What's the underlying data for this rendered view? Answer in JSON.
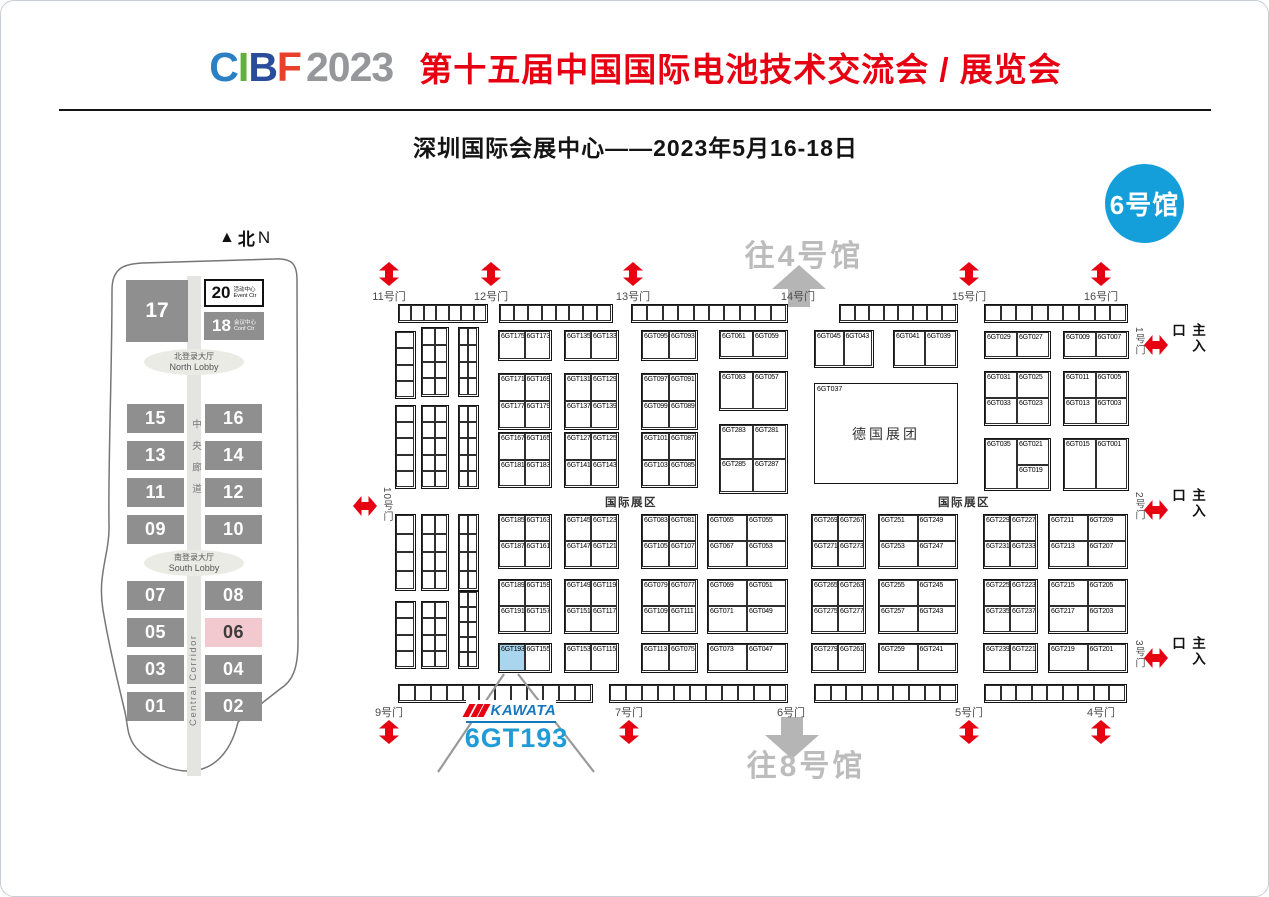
{
  "header": {
    "logo_letters": [
      {
        "ch": "C",
        "color": "#2b7fc3"
      },
      {
        "ch": "I",
        "color": "#62ae3e"
      },
      {
        "ch": "B",
        "color": "#2a4d9b"
      },
      {
        "ch": "F",
        "color": "#e8402a"
      },
      {
        "ch": "2023",
        "color": "#96979b"
      }
    ],
    "title": "第十五届中国国际电池技术交流会 / 展览会",
    "title_color": "#e60012",
    "subtitle": "深圳国际会展中心——2023年5月16-18日",
    "hall_badge": "6号馆",
    "hall_badge_color": "#149fdb"
  },
  "minimap": {
    "north_label_cn": "北",
    "north_label_en": "N",
    "hall17": "17",
    "event_center": {
      "num": "20",
      "cn": "活动中心",
      "en": "Event Ctr"
    },
    "conf_center": {
      "num": "18",
      "cn": "会议中心",
      "en": "Conf Ctr"
    },
    "north_lobby": {
      "cn": "北登录大厅",
      "en": "North Lobby"
    },
    "south_lobby": {
      "cn": "南登录大厅",
      "en": "South Lobby"
    },
    "corridor_cn": "中央廊道",
    "corridor_en": "Central Corridor",
    "halls_mid": [
      [
        "15",
        "16"
      ],
      [
        "13",
        "14"
      ],
      [
        "11",
        "12"
      ],
      [
        "09",
        "10"
      ]
    ],
    "halls_south": [
      [
        "07",
        "08"
      ],
      [
        "05",
        "06"
      ],
      [
        "03",
        "04"
      ],
      [
        "01",
        "02"
      ]
    ],
    "highlighted_hall": "06",
    "hall_color": "#8f8f8f",
    "highlight_color": "#f2c9ce"
  },
  "map": {
    "zone_label": "国际展区",
    "zone_label_positions": [
      {
        "x": 604,
        "y": 493
      },
      {
        "x": 937,
        "y": 493
      }
    ],
    "to_hall_4": "往4号馆",
    "to_hall_8": "往8号馆",
    "main_entrance_label": "主入口",
    "arrow_red": "#e60012",
    "arrow_gray": "#b5b5b5",
    "doors_top": [
      {
        "label": "11号门",
        "x": 388
      },
      {
        "label": "12号门",
        "x": 490
      },
      {
        "label": "13号门",
        "x": 632
      },
      {
        "label": "14号门",
        "x": 797,
        "gray": true
      },
      {
        "label": "15号门",
        "x": 968
      },
      {
        "label": "16号门",
        "x": 1100
      }
    ],
    "doors_bottom": [
      {
        "label": "9号门",
        "x": 388
      },
      {
        "label": "7号门",
        "x": 628
      },
      {
        "label": "6号门",
        "x": 790,
        "gray": true
      },
      {
        "label": "5号门",
        "x": 968
      },
      {
        "label": "4号门",
        "x": 1100
      }
    ],
    "door_left": {
      "label": "10号门",
      "x": 368,
      "y": 500
    },
    "entrances_right": [
      {
        "door": "1号门",
        "y": 344
      },
      {
        "door": "2号门",
        "y": 509
      },
      {
        "door": "3号门",
        "y": 657
      }
    ],
    "big_booth": {
      "id": "6GT037",
      "name": "德国展团",
      "x": 813,
      "y": 382,
      "w": 144,
      "h": 101
    },
    "highlight_booth": "6GT193",
    "highlight_color": "#a9d6ee",
    "callout": {
      "logo": "KAWATA",
      "booth": "6GT193"
    },
    "blocks": [
      {
        "x": 497,
        "y": 329,
        "w": 54,
        "h": 31,
        "rows": [
          [
            "6GT175",
            "6GT173"
          ]
        ]
      },
      {
        "x": 563,
        "y": 329,
        "w": 55,
        "h": 31,
        "rows": [
          [
            "6GT135",
            "6GT133"
          ]
        ]
      },
      {
        "x": 640,
        "y": 329,
        "w": 57,
        "h": 31,
        "rows": [
          [
            "6GT095",
            "6GT093"
          ]
        ]
      },
      {
        "x": 718,
        "y": 329,
        "w": 69,
        "h": 29,
        "rows": [
          [
            "6GT061",
            "6GT059"
          ]
        ]
      },
      {
        "x": 813,
        "y": 329,
        "w": 60,
        "h": 38,
        "rows": [
          [
            "6GT045",
            "6GT043"
          ]
        ]
      },
      {
        "x": 892,
        "y": 329,
        "w": 65,
        "h": 38,
        "rows": [
          [
            "6GT041",
            "6GT039"
          ]
        ]
      },
      {
        "x": 983,
        "y": 330,
        "w": 67,
        "h": 28,
        "rows": [
          [
            "6GT029",
            "6GT027"
          ]
        ]
      },
      {
        "x": 1062,
        "y": 330,
        "w": 66,
        "h": 28,
        "rows": [
          [
            "6GT009",
            "6GT007"
          ]
        ]
      },
      {
        "x": 497,
        "y": 372,
        "w": 54,
        "h": 57,
        "rows": [
          [
            "6GT171",
            "6GT169"
          ],
          [
            "6GT177",
            "6GT179"
          ]
        ]
      },
      {
        "x": 563,
        "y": 372,
        "w": 55,
        "h": 57,
        "rows": [
          [
            "6GT131",
            "6GT129"
          ],
          [
            "6GT137",
            "6GT139"
          ]
        ]
      },
      {
        "x": 640,
        "y": 372,
        "w": 57,
        "h": 57,
        "rows": [
          [
            "6GT097",
            "6GT091"
          ],
          [
            "6GT099",
            "6GT089"
          ]
        ]
      },
      {
        "x": 718,
        "y": 370,
        "w": 69,
        "h": 40,
        "rows": [
          [
            "6GT063",
            "6GT057"
          ]
        ]
      },
      {
        "x": 983,
        "y": 370,
        "w": 67,
        "h": 55,
        "rows": [
          [
            "6GT031",
            "6GT025"
          ],
          [
            "6GT033",
            "6GT023"
          ]
        ]
      },
      {
        "x": 1062,
        "y": 370,
        "w": 66,
        "h": 55,
        "rows": [
          [
            "6GT011",
            "6GT005"
          ],
          [
            "6GT013",
            "6GT003"
          ]
        ]
      },
      {
        "x": 497,
        "y": 431,
        "w": 54,
        "h": 56,
        "rows": [
          [
            "6GT167",
            "6GT165"
          ],
          [
            "6GT181",
            "6GT183"
          ]
        ]
      },
      {
        "x": 563,
        "y": 431,
        "w": 55,
        "h": 56,
        "rows": [
          [
            "6GT127",
            "6GT125"
          ],
          [
            "6GT141",
            "6GT143"
          ]
        ]
      },
      {
        "x": 640,
        "y": 431,
        "w": 57,
        "h": 56,
        "rows": [
          [
            "6GT101",
            "6GT087"
          ],
          [
            "6GT103",
            "6GT085"
          ]
        ]
      },
      {
        "x": 718,
        "y": 423,
        "w": 69,
        "h": 70,
        "rows": [
          [
            "6GT283",
            "6GT281"
          ],
          [
            "6GT285",
            "6GT287"
          ]
        ]
      },
      {
        "x": 983,
        "y": 437,
        "w": 67,
        "h": 53,
        "cells": [
          {
            "id": "6GT035",
            "fx": 0,
            "fy": 0,
            "fw": 0.5,
            "fh": 1
          },
          {
            "id": "6GT021",
            "fx": 0.5,
            "fy": 0,
            "fw": 0.5,
            "fh": 0.52
          },
          {
            "id": "6GT019",
            "fx": 0.5,
            "fy": 0.52,
            "fw": 0.5,
            "fh": 0.48
          }
        ]
      },
      {
        "x": 1062,
        "y": 437,
        "w": 66,
        "h": 53,
        "rows": [
          [
            "6GT015",
            "6GT001"
          ]
        ]
      },
      {
        "x": 497,
        "y": 513,
        "w": 54,
        "h": 55,
        "rows": [
          [
            "6GT185",
            "6GT163"
          ],
          [
            "6GT187",
            "6GT161"
          ]
        ]
      },
      {
        "x": 563,
        "y": 513,
        "w": 55,
        "h": 55,
        "rows": [
          [
            "6GT145",
            "6GT123"
          ],
          [
            "6GT147",
            "6GT121"
          ]
        ]
      },
      {
        "x": 640,
        "y": 513,
        "w": 57,
        "h": 55,
        "rows": [
          [
            "6GT083",
            "6GT081"
          ],
          [
            "6GT105",
            "6GT107"
          ]
        ]
      },
      {
        "x": 706,
        "y": 513,
        "w": 81,
        "h": 55,
        "rows": [
          [
            "6GT065",
            "6GT055"
          ],
          [
            "6GT067",
            "6GT053"
          ]
        ]
      },
      {
        "x": 810,
        "y": 513,
        "w": 55,
        "h": 55,
        "rows": [
          [
            "6GT269",
            "6GT267"
          ],
          [
            "6GT271",
            "6GT273"
          ]
        ]
      },
      {
        "x": 877,
        "y": 513,
        "w": 80,
        "h": 55,
        "rows": [
          [
            "6GT251",
            "6GT249"
          ],
          [
            "6GT253",
            "6GT247"
          ]
        ]
      },
      {
        "x": 982,
        "y": 513,
        "w": 55,
        "h": 55,
        "rows": [
          [
            "6GT229",
            "6GT227"
          ],
          [
            "6GT231",
            "6GT233"
          ]
        ]
      },
      {
        "x": 1047,
        "y": 513,
        "w": 80,
        "h": 55,
        "rows": [
          [
            "6GT211",
            "6GT209"
          ],
          [
            "6GT213",
            "6GT207"
          ]
        ]
      },
      {
        "x": 497,
        "y": 578,
        "w": 54,
        "h": 55,
        "rows": [
          [
            "6GT189",
            "6GT159"
          ],
          [
            "6GT191",
            "6GT157"
          ]
        ]
      },
      {
        "x": 563,
        "y": 578,
        "w": 55,
        "h": 55,
        "rows": [
          [
            "6GT149",
            "6GT119"
          ],
          [
            "6GT151",
            "6GT117"
          ]
        ]
      },
      {
        "x": 640,
        "y": 578,
        "w": 57,
        "h": 55,
        "rows": [
          [
            "6GT079",
            "6GT077"
          ],
          [
            "6GT109",
            "6GT111"
          ]
        ]
      },
      {
        "x": 706,
        "y": 578,
        "w": 81,
        "h": 55,
        "rows": [
          [
            "6GT069",
            "6GT051"
          ],
          [
            "6GT071",
            "6GT049"
          ]
        ]
      },
      {
        "x": 810,
        "y": 578,
        "w": 55,
        "h": 55,
        "rows": [
          [
            "6GT265",
            "6GT263"
          ],
          [
            "6GT275",
            "6GT277"
          ]
        ]
      },
      {
        "x": 877,
        "y": 578,
        "w": 80,
        "h": 55,
        "rows": [
          [
            "6GT255",
            "6GT245"
          ],
          [
            "6GT257",
            "6GT243"
          ]
        ]
      },
      {
        "x": 982,
        "y": 578,
        "w": 55,
        "h": 55,
        "rows": [
          [
            "6GT225",
            "6GT223"
          ],
          [
            "6GT235",
            "6GT237"
          ]
        ]
      },
      {
        "x": 1047,
        "y": 578,
        "w": 80,
        "h": 55,
        "rows": [
          [
            "6GT215",
            "6GT205"
          ],
          [
            "6GT217",
            "6GT203"
          ]
        ]
      },
      {
        "x": 497,
        "y": 642,
        "w": 54,
        "h": 30,
        "rows": [
          [
            "6GT193",
            "6GT155"
          ]
        ]
      },
      {
        "x": 563,
        "y": 642,
        "w": 55,
        "h": 30,
        "rows": [
          [
            "6GT153",
            "6GT115"
          ]
        ]
      },
      {
        "x": 640,
        "y": 642,
        "w": 57,
        "h": 30,
        "rows": [
          [
            "6GT113",
            "6GT075"
          ]
        ]
      },
      {
        "x": 706,
        "y": 642,
        "w": 81,
        "h": 30,
        "rows": [
          [
            "6GT073",
            "6GT047"
          ]
        ]
      },
      {
        "x": 810,
        "y": 642,
        "w": 55,
        "h": 30,
        "rows": [
          [
            "6GT279",
            "6GT261"
          ]
        ]
      },
      {
        "x": 877,
        "y": 642,
        "w": 80,
        "h": 30,
        "rows": [
          [
            "6GT259",
            "6GT241"
          ]
        ]
      },
      {
        "x": 982,
        "y": 642,
        "w": 55,
        "h": 30,
        "rows": [
          [
            "6GT239",
            "6GT221"
          ]
        ]
      },
      {
        "x": 1047,
        "y": 642,
        "w": 80,
        "h": 30,
        "rows": [
          [
            "6GT219",
            "6GT201"
          ]
        ]
      }
    ],
    "strips_top": [
      {
        "x": 397,
        "y": 303,
        "w": 90,
        "cells": 7
      },
      {
        "x": 498,
        "y": 303,
        "w": 114,
        "cells": 8
      },
      {
        "x": 630,
        "y": 303,
        "w": 157,
        "cells": 10
      },
      {
        "x": 838,
        "y": 303,
        "w": 119,
        "cells": 8
      },
      {
        "x": 983,
        "y": 303,
        "w": 144,
        "cells": 9
      }
    ],
    "strips_bottom": [
      {
        "x": 397,
        "y": 683,
        "w": 195,
        "cells": 12
      },
      {
        "x": 608,
        "y": 683,
        "w": 179,
        "cells": 11
      },
      {
        "x": 813,
        "y": 683,
        "w": 144,
        "cells": 9
      },
      {
        "x": 983,
        "y": 683,
        "w": 143,
        "cells": 9
      }
    ],
    "tiny_groups": [
      {
        "x": 394,
        "w": 21,
        "cols": 1,
        "stacks": [
          [
            330,
            68,
            4
          ],
          [
            404,
            84,
            5
          ],
          [
            513,
            77,
            4
          ],
          [
            600,
            68,
            4
          ]
        ]
      },
      {
        "x": 420,
        "w": 28,
        "cols": 2,
        "stacks": [
          [
            326,
            70,
            4
          ],
          [
            404,
            84,
            5
          ],
          [
            513,
            77,
            4
          ],
          [
            600,
            68,
            4
          ]
        ]
      },
      {
        "x": 457,
        "w": 21,
        "cols": 2,
        "stacks": [
          [
            326,
            70,
            4
          ],
          [
            404,
            84,
            5
          ],
          [
            513,
            77,
            4
          ],
          [
            590,
            78,
            5
          ]
        ]
      }
    ]
  }
}
